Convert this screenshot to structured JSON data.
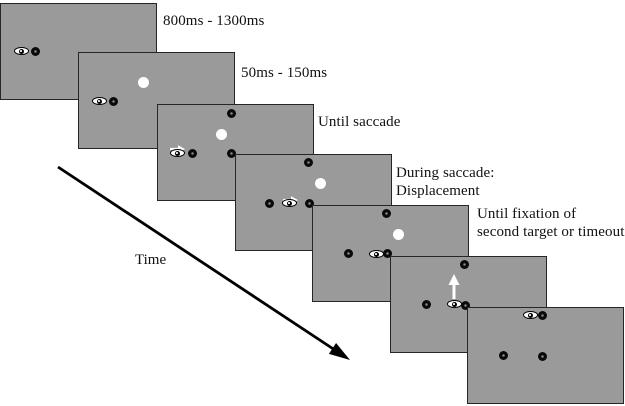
{
  "colors": {
    "background": "#ffffff",
    "panel_fill": "#9a9a9a",
    "panel_border": "#262626",
    "text": "#111111",
    "stimulus_black": "#0a0a0a",
    "stimulus_white": "#ffffff",
    "time_arrow": "#000000"
  },
  "canvas": {
    "width": 625,
    "height": 406
  },
  "panel_size": {
    "width": 157,
    "height": 97
  },
  "time_arrow": {
    "label": "Time",
    "label_x": 135,
    "label_y": 252,
    "x1": 58,
    "y1": 167,
    "x2": 350,
    "y2": 360
  },
  "panels": [
    {
      "name": "fixation",
      "x": 0,
      "y": 3,
      "label": "800ms - 1300ms",
      "label_x": 163,
      "label_y": 12,
      "items": [
        {
          "t": "eye",
          "x": 20,
          "y": 47
        },
        {
          "t": "dot",
          "x": 34,
          "y": 47
        }
      ]
    },
    {
      "name": "target-onset",
      "x": 78,
      "y": 52,
      "label": "50ms - 150ms",
      "label_x": 241,
      "label_y": 64,
      "items": [
        {
          "t": "white",
          "x": 64,
          "y": 29
        },
        {
          "t": "eye",
          "x": 20,
          "y": 48
        },
        {
          "t": "dot",
          "x": 34,
          "y": 48
        }
      ]
    },
    {
      "name": "until-saccade",
      "x": 157,
      "y": 104,
      "label": "Until saccade",
      "label_x": 318,
      "label_y": 113,
      "items": [
        {
          "t": "dot",
          "x": 73,
          "y": 8
        },
        {
          "t": "white",
          "x": 63,
          "y": 29
        },
        {
          "t": "arrow-right",
          "x": 19,
          "y": 39
        },
        {
          "t": "eye",
          "x": 19,
          "y": 48
        },
        {
          "t": "dot",
          "x": 34,
          "y": 48
        },
        {
          "t": "dot",
          "x": 73,
          "y": 48
        }
      ]
    },
    {
      "name": "during-saccade-displacement",
      "x": 235,
      "y": 154,
      "label": "During saccade:\nDisplacement",
      "label_x": 396,
      "label_y": 164,
      "items": [
        {
          "t": "dot",
          "x": 72,
          "y": 7
        },
        {
          "t": "white",
          "x": 84,
          "y": 28
        },
        {
          "t": "arrow-right",
          "x": 54,
          "y": 40
        },
        {
          "t": "dot",
          "x": 33,
          "y": 48
        },
        {
          "t": "eye",
          "x": 53,
          "y": 48
        },
        {
          "t": "dot",
          "x": 73,
          "y": 48
        }
      ]
    },
    {
      "name": "until-fixation-second-target",
      "x": 312,
      "y": 205,
      "label": "Until fixation of\nsecond target or timeout",
      "label_x": 477,
      "label_y": 205,
      "items": [
        {
          "t": "dot",
          "x": 73,
          "y": 7
        },
        {
          "t": "white",
          "x": 85,
          "y": 28
        },
        {
          "t": "dot",
          "x": 35,
          "y": 47
        },
        {
          "t": "eye",
          "x": 63,
          "y": 48
        },
        {
          "t": "dot",
          "x": 74,
          "y": 47
        }
      ]
    },
    {
      "name": "second-saccade",
      "x": 390,
      "y": 256,
      "label": null,
      "items": [
        {
          "t": "dot",
          "x": 73,
          "y": 7
        },
        {
          "t": "arrow-up",
          "x": 63,
          "y": 30
        },
        {
          "t": "dot",
          "x": 35,
          "y": 47
        },
        {
          "t": "eye",
          "x": 63,
          "y": 47
        },
        {
          "t": "dot",
          "x": 74,
          "y": 48
        }
      ]
    },
    {
      "name": "final-display",
      "x": 467,
      "y": 307,
      "label": null,
      "items": [
        {
          "t": "eye",
          "x": 62,
          "y": 7
        },
        {
          "t": "dot",
          "x": 74,
          "y": 7
        },
        {
          "t": "dot",
          "x": 35,
          "y": 47
        },
        {
          "t": "dot",
          "x": 74,
          "y": 48
        }
      ]
    }
  ]
}
